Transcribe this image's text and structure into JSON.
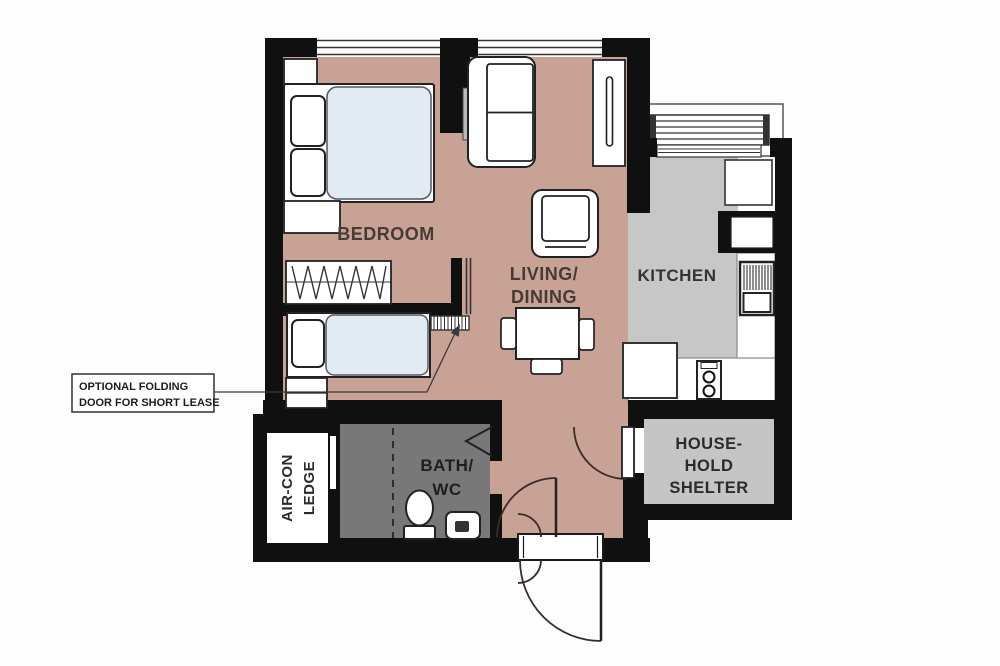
{
  "rooms": {
    "bedroom": {
      "label": "BEDROOM"
    },
    "living": {
      "lines": [
        "LIVING/",
        "DINING"
      ]
    },
    "kitchen": {
      "label": "KITCHEN"
    },
    "bath": {
      "lines": [
        "BATH/",
        "WC"
      ]
    },
    "shelter": {
      "lines": [
        "HOUSE-",
        "HOLD",
        "SHELTER"
      ]
    },
    "aircon": {
      "lines": [
        "AIR-CON",
        "LEDGE"
      ]
    }
  },
  "annotation": {
    "line1": "OPTIONAL FOLDING",
    "line2": "DOOR FOR SHORT LEASE"
  },
  "colors": {
    "wall": "#101010",
    "floor_living": "#c9a296",
    "floor_kitchen": "#c7c7c7",
    "floor_bath": "#787878",
    "floor_shelter": "#c5c5c5",
    "mattress": "#e2ebf1",
    "label_text": "#443c35"
  },
  "furniture_symbols": [
    "double-bed",
    "single-bed",
    "pillows",
    "wardrobe",
    "bench",
    "sofa",
    "tv-console",
    "armchair",
    "dining-table",
    "dining-chairs",
    "folding-door",
    "toilet",
    "wash-basin",
    "shower-screen",
    "cooktop",
    "kitchen-sink",
    "fridge",
    "washer",
    "drying-rack",
    "entrance-door",
    "shelter-door",
    "bath-door"
  ]
}
